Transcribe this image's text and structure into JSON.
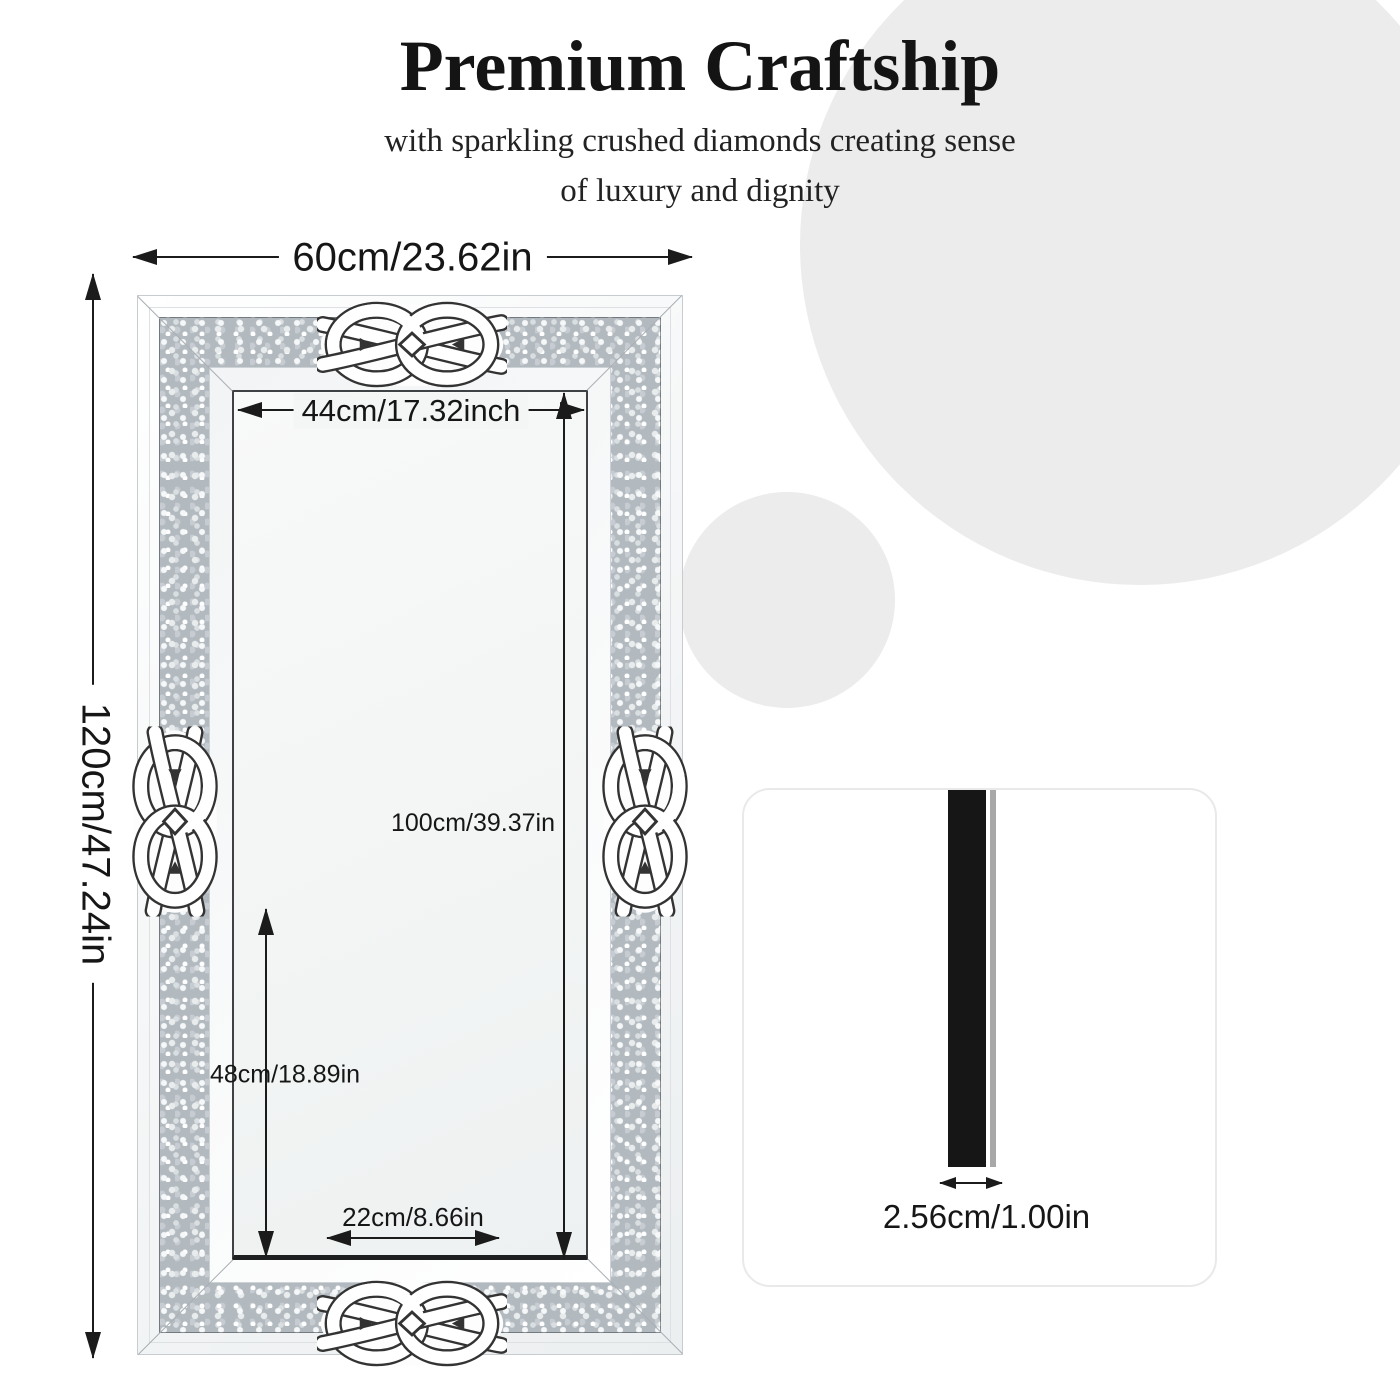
{
  "header": {
    "title": "Premium Craftship",
    "subtitle_line1": "with sparkling crushed diamonds creating sense",
    "subtitle_line2": "of luxury and dignity"
  },
  "mirror_diagram": {
    "outer_width": "60cm/23.62in",
    "outer_height": "120cm/47.24in",
    "inner_width": "44cm/17.32inch",
    "inner_height": "100cm/39.37in",
    "lower_section_height": "48cm/18.89in",
    "bottom_knot_width": "22cm/8.66in",
    "decorations": [
      "celtic-knot-top-icon",
      "celtic-knot-bottom-icon",
      "celtic-knot-left-icon",
      "celtic-knot-right-icon"
    ]
  },
  "side_view": {
    "thickness": "2.56cm/1.00in"
  },
  "colors": {
    "background": "#ffffff",
    "background_circle": "#ececec",
    "dimension_line": "#1b1b1b",
    "diamond_band_base": "#b2bac0",
    "side_bar": "#161616",
    "card_border": "#e9e9e9"
  }
}
